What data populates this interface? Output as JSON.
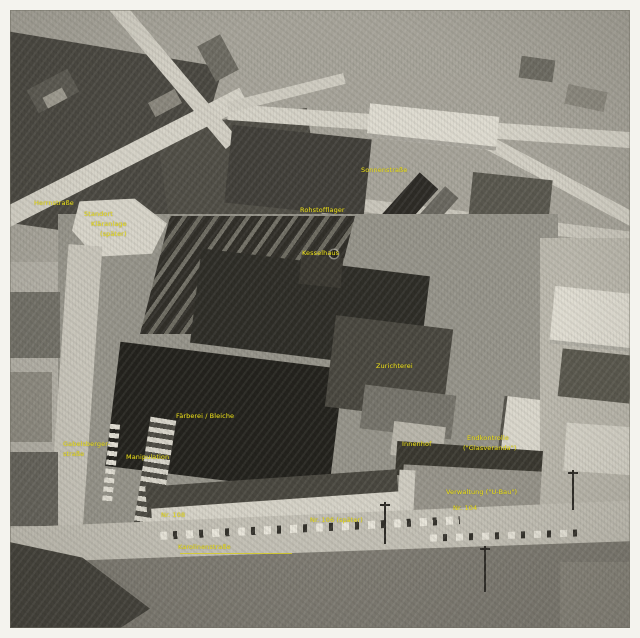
{
  "photo": {
    "kind": "black-and-white aerial photograph of a factory complex",
    "annotation_color": "#ede21e",
    "frame_color": "#f4f3ee"
  },
  "labels": {
    "herrnstrasse": "Herrnstraße",
    "standort1": "Standort",
    "standort2": "Kläranlage",
    "standort3": "(später)",
    "sonnenstrasse": "Sonnenstraße",
    "rohstofflager": "Rohstofflager",
    "kesselhaus": "Kesselhaus",
    "zurichterei": "Zurichterei",
    "faerberei": "Färberei / Bleiche",
    "weststrasse1": "Gabelsberger-",
    "weststrasse2": "straße",
    "manipulation": "Manipulation",
    "innenhof": "Innenhof",
    "endkontrolle1": "Endkontrolle",
    "endkontrolle2": "(\"Glasveranda\")",
    "verwaltung": "Verwaltung (\"U-Bau\")",
    "nr104": "Nr. 104",
    "nr108": "Nr. 108",
    "nr106": "Nr. 106 (später)",
    "karolinenstrasse": "Karolinenstraße"
  }
}
